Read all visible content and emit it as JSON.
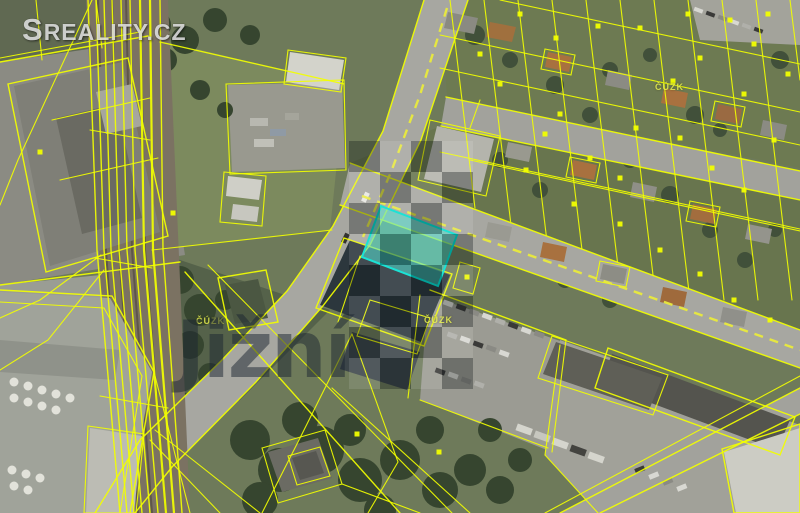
{
  "branding": {
    "logo": "SREALITY.CZ"
  },
  "watermarks": {
    "district": "Jižní",
    "attribution": "ČÚZK",
    "attribution_positions": [
      [
        196,
        316
      ],
      [
        424,
        315
      ],
      [
        655,
        82
      ]
    ],
    "checker": {
      "x": 349,
      "y": 141,
      "cell": 31,
      "cols": 4,
      "rows": 8
    }
  },
  "map": {
    "type": "aerial-cadastral-overlay",
    "highlighted_parcel": {
      "shape": "quadrilateral",
      "status": "selected"
    },
    "colors": {
      "cadastral-line": "#F2FF00",
      "highlight-fill": "#40E0D0",
      "highlight-stroke": "#00DFD0",
      "dashed-centerline": "#E9EA3C",
      "road-surface": "#A7A7A1",
      "rail-bed": "#7B7262",
      "grass": "#75825A",
      "tree": "#36452F",
      "logo-text": "#DCDCDC",
      "district-watermark": "#1B2531",
      "attribution-text": "#EDF550",
      "checker-dark": "rgba(8,12,16,0.30)",
      "checker-light": "rgba(255,255,255,0.11)"
    },
    "parcel_markers": [
      [
        520,
        14
      ],
      [
        556,
        38
      ],
      [
        598,
        26
      ],
      [
        636,
        128
      ],
      [
        673,
        81
      ],
      [
        700,
        58
      ],
      [
        744,
        94
      ],
      [
        774,
        140
      ],
      [
        712,
        168
      ],
      [
        744,
        190
      ],
      [
        560,
        114
      ],
      [
        500,
        84
      ],
      [
        480,
        54
      ],
      [
        526,
        170
      ],
      [
        574,
        204
      ],
      [
        620,
        224
      ],
      [
        660,
        250
      ],
      [
        700,
        274
      ],
      [
        734,
        300
      ],
      [
        770,
        320
      ],
      [
        620,
        178
      ],
      [
        680,
        138
      ],
      [
        590,
        158
      ],
      [
        545,
        134
      ],
      [
        754,
        44
      ],
      [
        788,
        74
      ],
      [
        640,
        28
      ],
      [
        688,
        14
      ],
      [
        730,
        20
      ],
      [
        768,
        14
      ],
      [
        357,
        434
      ],
      [
        439,
        452
      ],
      [
        467,
        277
      ],
      [
        40,
        152
      ],
      [
        173,
        213
      ]
    ]
  }
}
